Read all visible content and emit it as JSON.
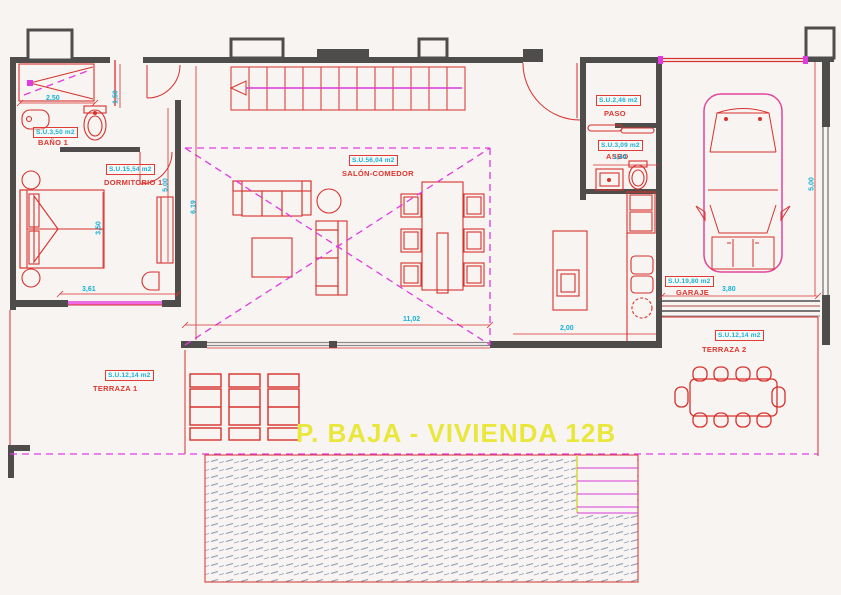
{
  "title": "P. BAJA - VIVIENDA 12B",
  "rooms": {
    "bano1": {
      "name": "BAÑO 1",
      "area": "S.U.3,50 m2"
    },
    "dormitorio1": {
      "name": "DORMITORIO 1",
      "area": "S.U.15,54 m2"
    },
    "salon": {
      "name": "SALÓN-COMEDOR",
      "area": "S.U.56,04 m2"
    },
    "paso": {
      "name": "PASO",
      "area": "S.U.2,46 m2"
    },
    "aseo": {
      "name": "ASEO",
      "area": "S.U.3,09 m2"
    },
    "garaje": {
      "name": "GARAJE",
      "area": "S.U.19,80 m2"
    },
    "terraza1": {
      "name": "TERRAZA 1",
      "area": "S.U.12,14 m2"
    },
    "terraza2": {
      "name": "TERRAZA 2",
      "area": "S.U.12,14 m2"
    }
  },
  "dims": {
    "bano_w": "2,50",
    "bano_h": "1,50",
    "dorm_h": "3,50",
    "dorm_w": "3,61",
    "dorm_r": "5,00",
    "salon_l": "6,19",
    "salon_w": "11,02",
    "kitchen_w": "2,00",
    "aseo_w": "1,44",
    "garaje_w": "3,80",
    "garaje_h": "5,00"
  },
  "colors": {
    "walls": "#4f4c4c",
    "lines_red": "#d8312c",
    "lines_magenta": "#e23ae2",
    "text_cyan": "#17b0d4",
    "title_yellow": "#e9e73c",
    "pool_hatch": "#8b96b4"
  }
}
